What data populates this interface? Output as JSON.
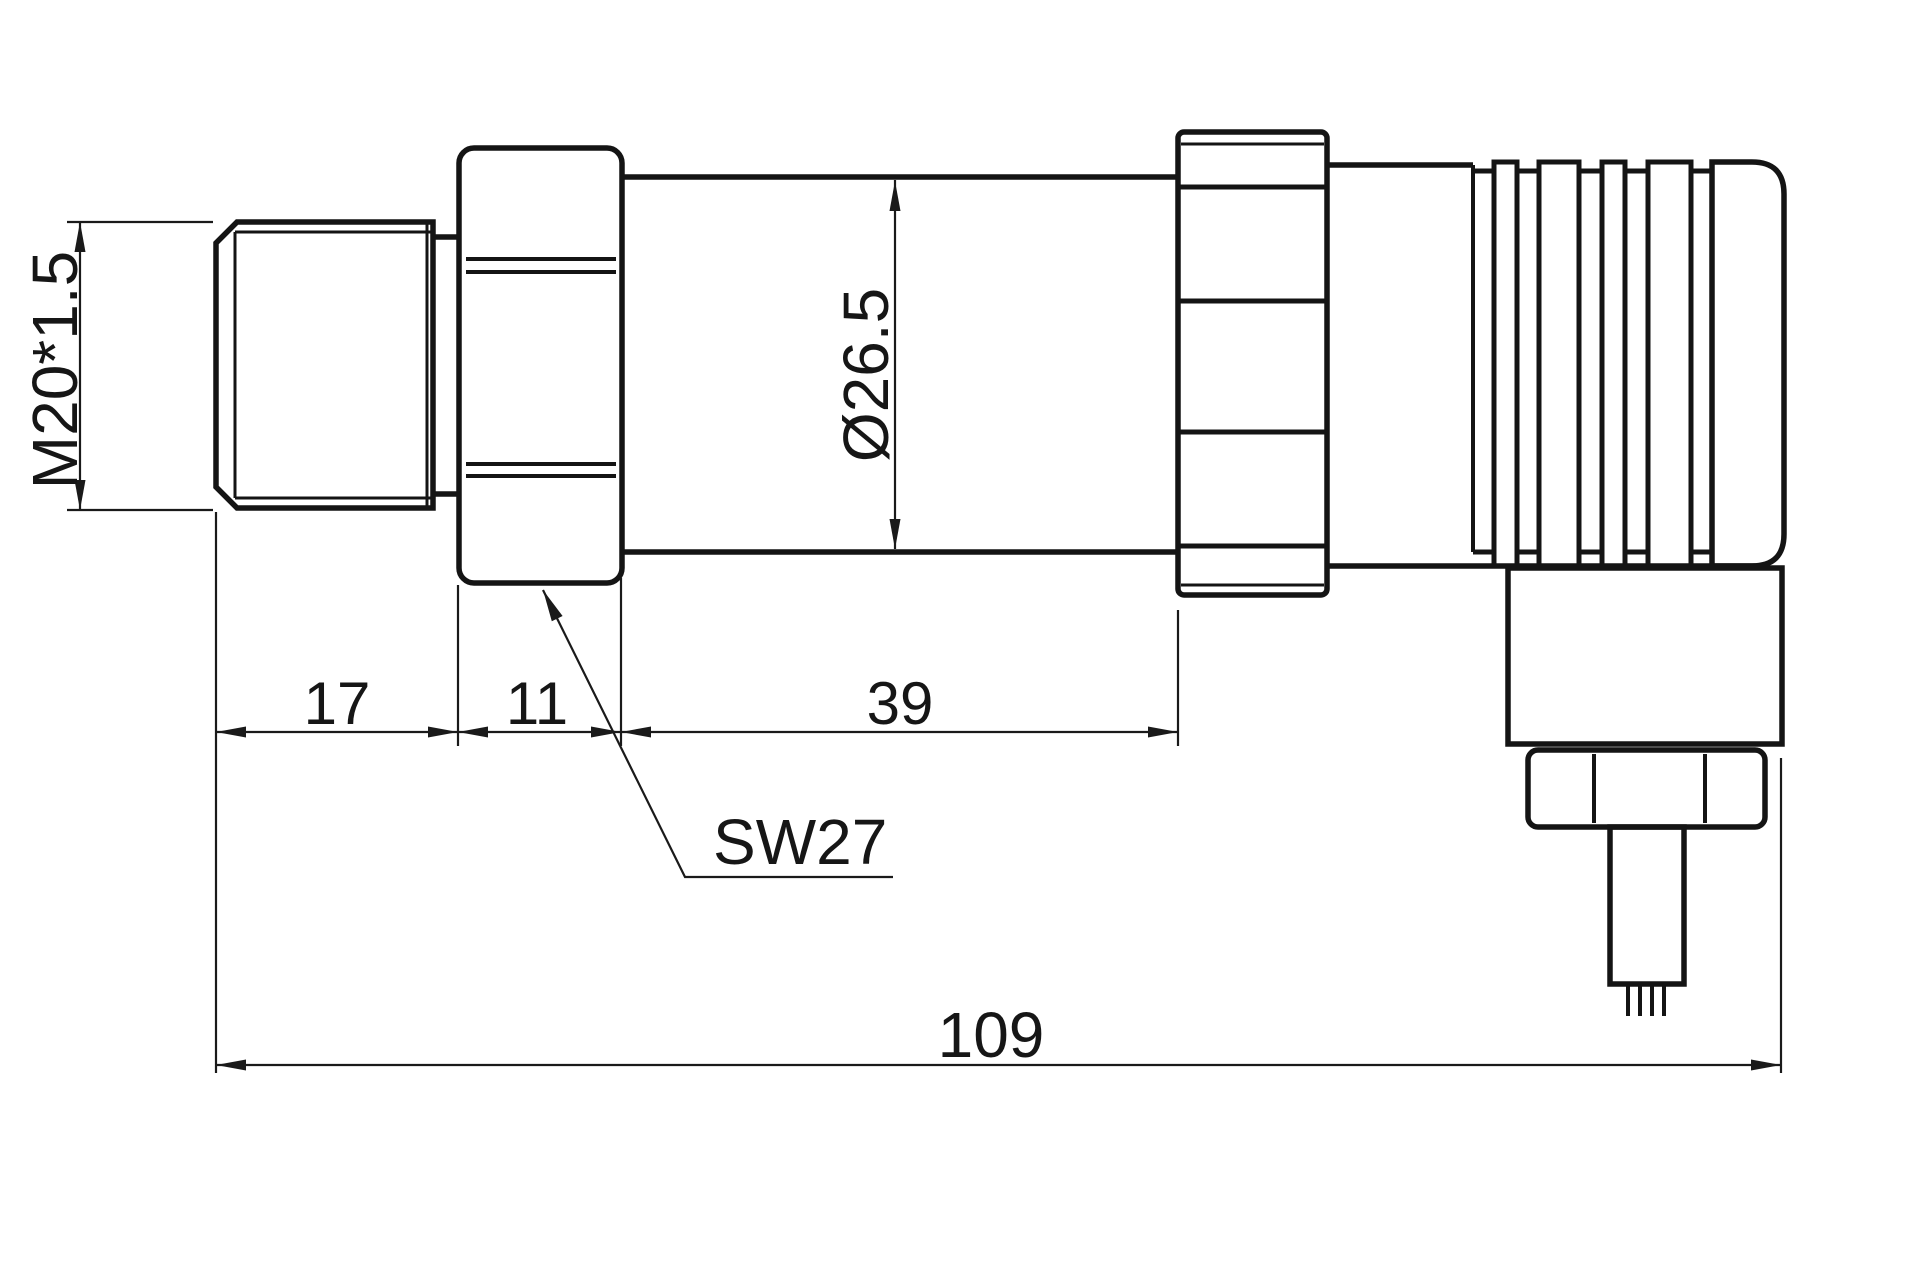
{
  "drawing": {
    "background": "#ffffff",
    "line_color": "#161616",
    "labels": {
      "thread_spec": "M20*1.5",
      "body_diameter": "Ø26.5",
      "thread_length": "17",
      "hex_length": "11",
      "body_length": "39",
      "wrench_size": "SW27",
      "overall_length": "109"
    }
  }
}
